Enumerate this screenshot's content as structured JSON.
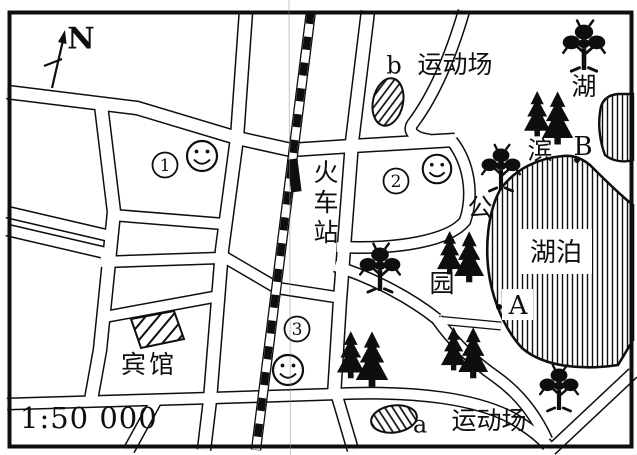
{
  "compass": {
    "label": "N"
  },
  "scale_bar": {
    "text": "1:50 000"
  },
  "railway_station": {
    "name": "火车站",
    "char1": "火",
    "char2": "车",
    "char3": "站"
  },
  "hotel": {
    "label": "宾馆"
  },
  "lake": {
    "label": "湖泊"
  },
  "park": {
    "name": "湖滨公园",
    "char1": "湖",
    "char2": "滨",
    "char3": "公",
    "char4": "园"
  },
  "sports_field_b": {
    "point": "b",
    "label": "运动场"
  },
  "sports_field_a": {
    "point": "a",
    "label": "运动场"
  },
  "points": {
    "a": "A",
    "b": "B"
  },
  "site_markers": {
    "m1": "1",
    "m2": "2",
    "m3": "3"
  },
  "colors": {
    "ink": "#0e0e0e",
    "paper": "#ffffff"
  }
}
